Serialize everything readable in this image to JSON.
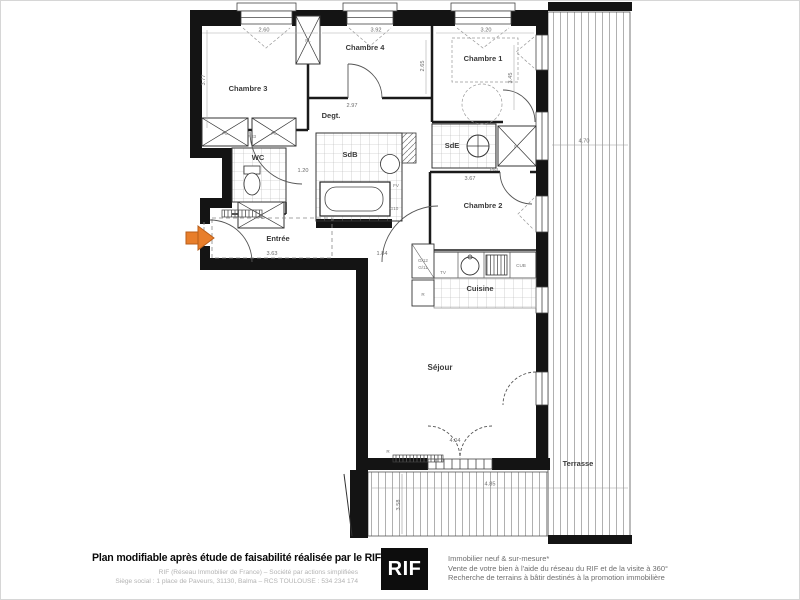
{
  "plan": {
    "rooms": {
      "chambre3": "Chambre 3",
      "chambre4": "Chambre 4",
      "chambre1": "Chambre 1",
      "chambre2": "Chambre 2",
      "degagement": "Degt.",
      "wc": "WC",
      "sdb": "SdB",
      "sde": "SdE",
      "entree": "Entrée",
      "cuisine": "Cuisine",
      "sejour": "Séjour",
      "terrasse": "Terrasse"
    },
    "dimensions": {
      "w_ch3": "2.60",
      "w_ch4": "3.92",
      "w_ch1": "3.20",
      "h_ch3": "3.77",
      "h_ch4": "2.65",
      "h_ch1": "3.45",
      "w_degt": "2.97",
      "w_couloir": "1.20",
      "w_ch2": "3.67",
      "w_entree": "3.63",
      "w_passage": "1.84",
      "terrasse_len": "4.70",
      "terrasse_w": "4.85",
      "terrasse_h": "3.58",
      "w_baie": "4.04"
    },
    "tags": {
      "placard": "PL",
      "radiator": "R",
      "tv": "TV",
      "fv": "FV",
      "cub": "CUB",
      "g10": "G10",
      "g12": "G/12",
      "g11": "G/11",
      "door": "P83"
    }
  },
  "footer": {
    "headline": "Plan modifiable après étude de faisabilité réalisée par le RIF",
    "legal_line1": "RIF (Réseau Immobilier de France) – Société par actions simplifiées",
    "legal_line2": "Siège social : 1 place de Paveurs, 31130, Balma – RCS TOULOUSE : 534 234 174",
    "logo": "RIF",
    "services_line1": "Immobilier neuf & sur-mesure*",
    "services_line2": "Vente de votre bien à l'aide du réseau du RIF et de la visite à 360°",
    "services_line3": "Recherche de terrains à bâtir destinés à la promotion immobilière"
  },
  "colors": {
    "wall": "#141414",
    "accent_arrow": "#E87E2B",
    "line": "#555555"
  }
}
